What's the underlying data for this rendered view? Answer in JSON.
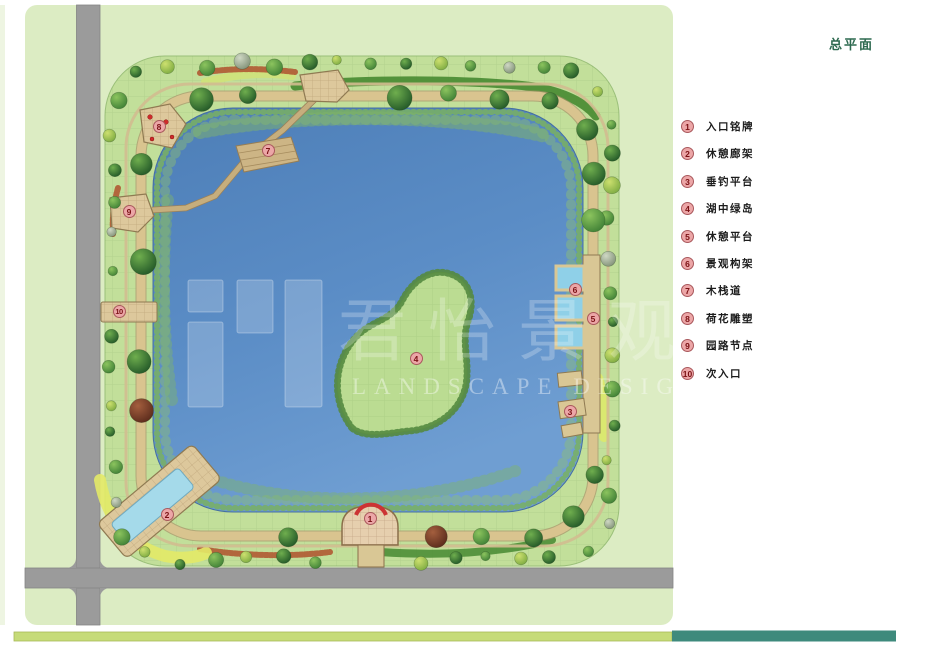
{
  "title": "总平面",
  "watermark": {
    "cn": "君怡景观",
    "en": "LANDSCAPE DESIGN"
  },
  "legend": {
    "items": [
      {
        "num": "1",
        "label": "入口铭牌"
      },
      {
        "num": "2",
        "label": "休憩廊架"
      },
      {
        "num": "3",
        "label": "垂钓平台"
      },
      {
        "num": "4",
        "label": "湖中绿岛"
      },
      {
        "num": "5",
        "label": "休憩平台"
      },
      {
        "num": "6",
        "label": "景观构架"
      },
      {
        "num": "7",
        "label": "木栈道"
      },
      {
        "num": "8",
        "label": "荷花雕塑"
      },
      {
        "num": "9",
        "label": "园路节点"
      },
      {
        "num": "10",
        "label": "次入口"
      }
    ]
  },
  "markers": [
    {
      "num": "1",
      "x": 371,
      "y": 519
    },
    {
      "num": "2",
      "x": 168,
      "y": 515
    },
    {
      "num": "3",
      "x": 571,
      "y": 412
    },
    {
      "num": "4",
      "x": 417,
      "y": 359
    },
    {
      "num": "5",
      "x": 594,
      "y": 319
    },
    {
      "num": "6",
      "x": 576,
      "y": 290
    },
    {
      "num": "7",
      "x": 269,
      "y": 151
    },
    {
      "num": "8",
      "x": 160,
      "y": 127
    },
    {
      "num": "9",
      "x": 130,
      "y": 212
    },
    {
      "num": "10",
      "x": 120,
      "y": 312
    }
  ],
  "colors": {
    "canvas": "#dcecc3",
    "road": "#9b9b9b",
    "lake": "#5b8dc6",
    "bar_green": "#c6db79",
    "bar_teal": "#3e8a7c",
    "title_text": "#2e6a50",
    "badge_bg": "#eca6a7",
    "badge_border": "#a9585c",
    "badge_text": "#7a1114"
  }
}
